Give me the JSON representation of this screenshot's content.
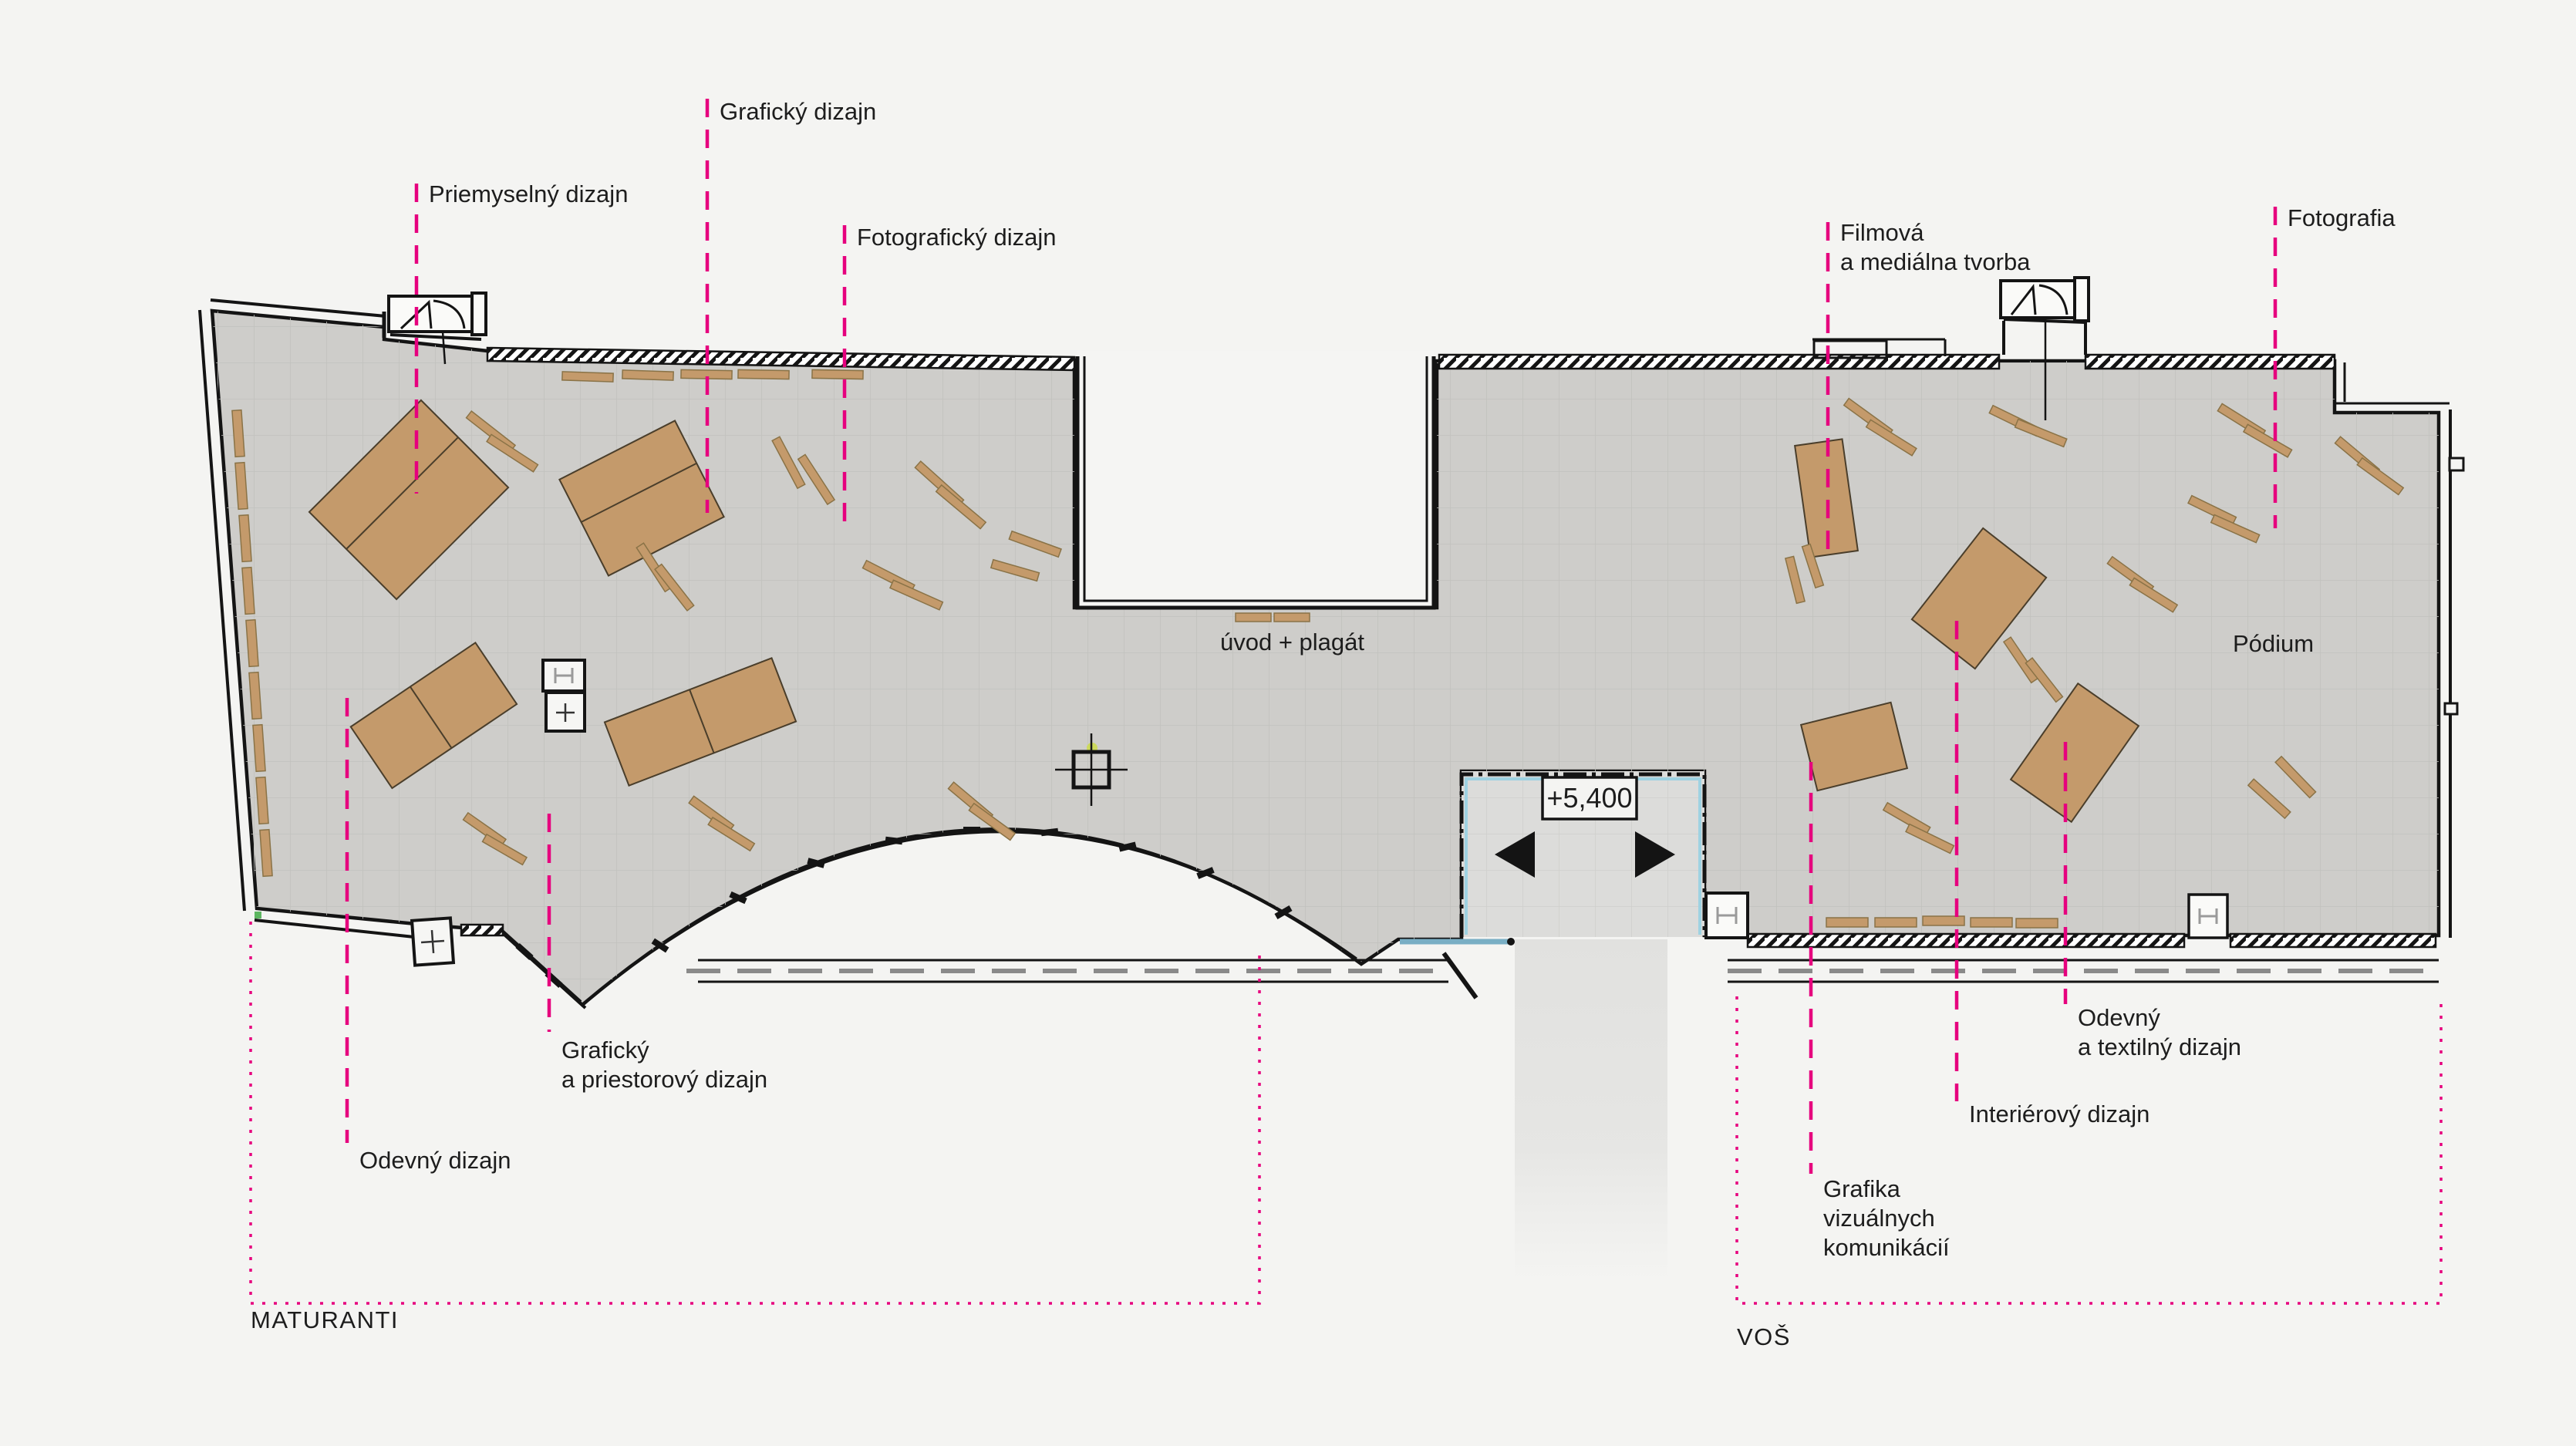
{
  "colors": {
    "accent_magenta": "#E6007E",
    "floor_gray": "#CECDCA",
    "furniture_tan": "#C49A6B",
    "glazing_cyan": "#9ED2E2",
    "background": "#F4F4F2",
    "wall_black": "#141414"
  },
  "groups": {
    "maturanti": "MATURANTI",
    "vos": "VOŠ"
  },
  "areas": {
    "priemyselny": {
      "label": "Priemyselný dizajn"
    },
    "graficky": {
      "label": "Grafický dizajn"
    },
    "fotograficky": {
      "label": "Fotografický dizajn"
    },
    "graficky_priestorovy": {
      "lines": [
        "Grafický",
        "a priestorový dizajn"
      ]
    },
    "odevny": {
      "label": "Odevný dizajn"
    },
    "filmova": {
      "lines": [
        "Filmová",
        "a mediálna tvorba"
      ]
    },
    "fotografia": {
      "label": "Fotografia"
    },
    "grafika_vk": {
      "lines": [
        "Grafika",
        "vizuálnych",
        "komunikácií"
      ]
    },
    "interierovy": {
      "label": "Interiérový dizajn"
    },
    "odevny_textilny": {
      "lines": [
        "Odevný",
        "a textilný dizajn"
      ]
    }
  },
  "annotations": {
    "uvod_plagat": "úvod + plagát",
    "podium": "Pódium",
    "elevation": "+5,400"
  }
}
